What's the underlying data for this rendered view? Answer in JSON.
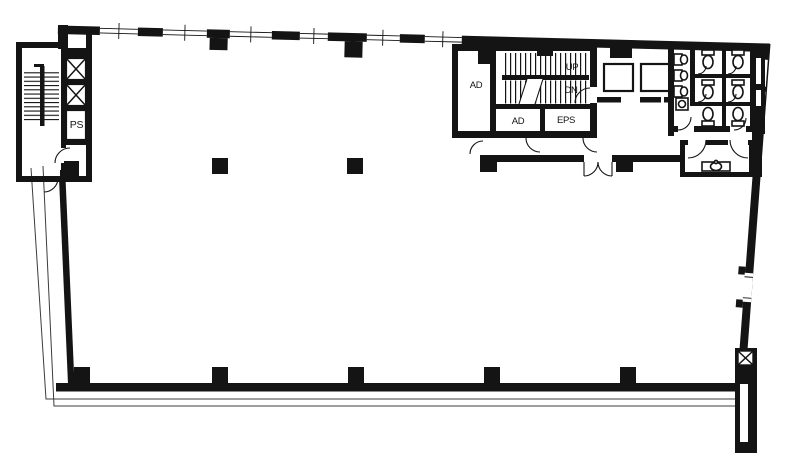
{
  "plan": {
    "type": "building-floor-plan",
    "labels": {
      "ps": "PS",
      "ad_west": "AD",
      "up": "UP",
      "dn": "DN",
      "ad_south": "AD",
      "eps": "EPS"
    },
    "colors": {
      "wall": "#141414",
      "background": "#ffffff",
      "boundary_line": "#3c3c3c"
    }
  }
}
